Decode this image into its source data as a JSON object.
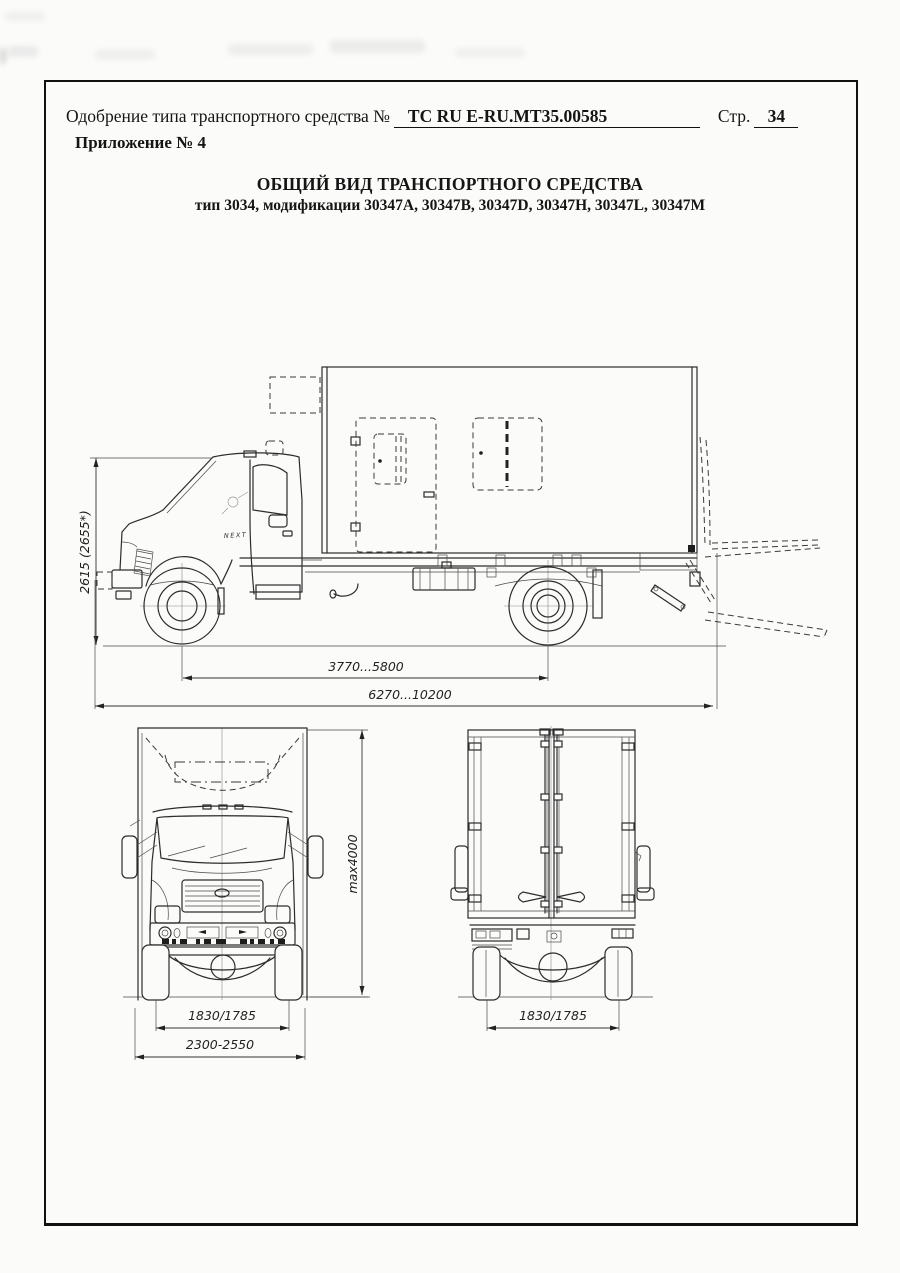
{
  "colors": {
    "ink": "#151515",
    "line": "#2c2c2c",
    "paper": "#fbfbfa"
  },
  "header": {
    "approval_label": "Одобрение типа транспортного средства №",
    "approval_number": "ТС RU E-RU.MT35.00585",
    "page_label": "Стр.",
    "page_number": "34",
    "appendix_label": "Приложение № 4"
  },
  "title": {
    "line1": "ОБЩИЙ ВИД ТРАНСПОРТНОГО СРЕДСТВА",
    "line2": "тип 3034, модификации 30347A, 30347B, 30347D, 30347H, 30347L, 30347M"
  },
  "drawing": {
    "cab_badge": "NEXT",
    "side_view": {
      "dim_height": "2615 (2655*)",
      "dim_wheelbase": "3770...5800",
      "dim_length": "6270...10200"
    },
    "front_view": {
      "dim_height": "max4000",
      "dim_track": "1830/1785",
      "dim_width": "2300-2550"
    },
    "rear_view": {
      "dim_track": "1830/1785"
    }
  }
}
